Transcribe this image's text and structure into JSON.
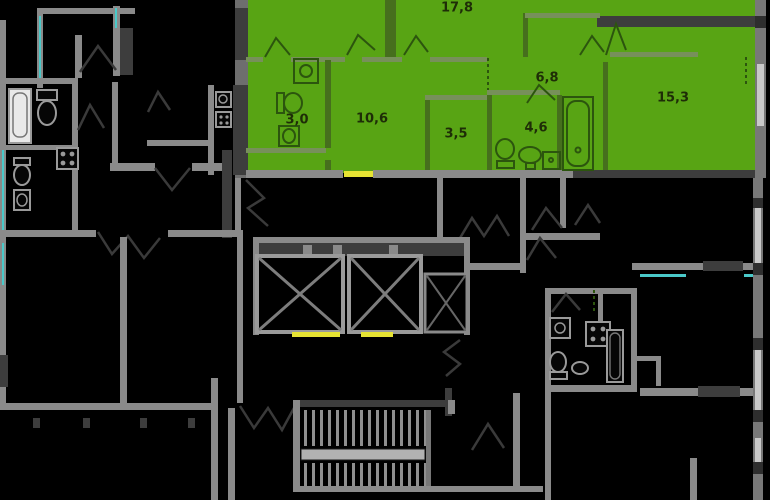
{
  "floor_plan": {
    "rooms": [
      "17,8",
      "6,8",
      "15,3",
      "3,0",
      "10,6",
      "3,5",
      "4,6"
    ],
    "colors": {
      "highlight_green": "#58a414",
      "highlight_wall_dark": "#466f1d",
      "highlight_wall_light": "#77905a",
      "wall_grey": "#8a8a8a",
      "wall_dark": "#3d3d3d",
      "window_teal": "#4ac9c9",
      "door_sill_yellow": "#e6e333",
      "background": "#000000",
      "label_text": "#1e2d07"
    },
    "icons": [
      "bathtub-icon",
      "toilet-icon",
      "sink-icon",
      "stove-icon",
      "washing-machine-icon",
      "elevator-shaft-x-icon",
      "staircase-icon",
      "door-swing-icon",
      "window-marker",
      "door-sill-marker"
    ]
  }
}
